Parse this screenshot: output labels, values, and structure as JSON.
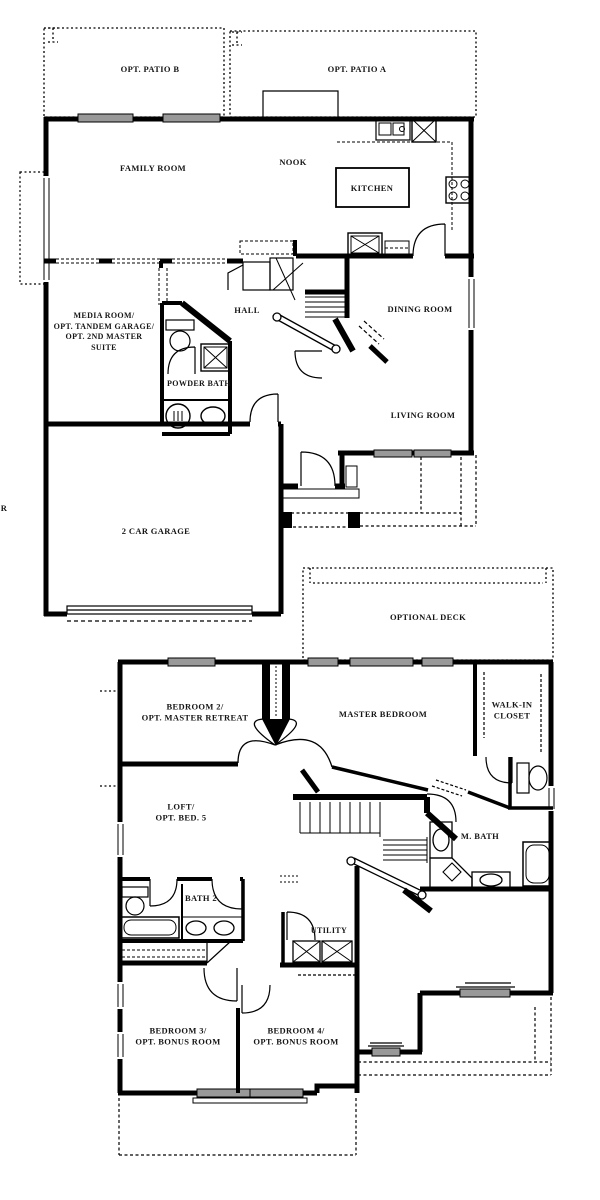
{
  "colors": {
    "wall": "#000000",
    "window_fill": "#999999",
    "paper": "#ffffff"
  },
  "floor1": {
    "patio_b": "OPT. PATIO B",
    "patio_a": "OPT. PATIO A",
    "family_room": "FAMILY ROOM",
    "nook": "NOOK",
    "kitchen": "KITCHEN",
    "media_room": "MEDIA ROOM/\nOPT. TANDEM GARAGE/\nOPT. 2ND MASTER\nSUITE",
    "hall": "HALL",
    "dining_room": "DINING ROOM",
    "powder_bath": "POWDER BATH",
    "living_room": "LIVING ROOM",
    "garage": "2 CAR GARAGE",
    "edge_letter": "R"
  },
  "floor2": {
    "optional_deck": "OPTIONAL DECK",
    "bedroom2": "BEDROOM 2/\nOPT. MASTER RETREAT",
    "master_bedroom": "MASTER BEDROOM",
    "walk_in_closet": "WALK-IN\nCLOSET",
    "loft": "LOFT/\nOPT. BED. 5",
    "m_bath": "M. BATH",
    "bath2": "BATH 2",
    "utility": "UTILITY",
    "bedroom3": "BEDROOM 3/\nOPT. BONUS ROOM",
    "bedroom4": "BEDROOM 4/\nOPT. BONUS ROOM"
  }
}
